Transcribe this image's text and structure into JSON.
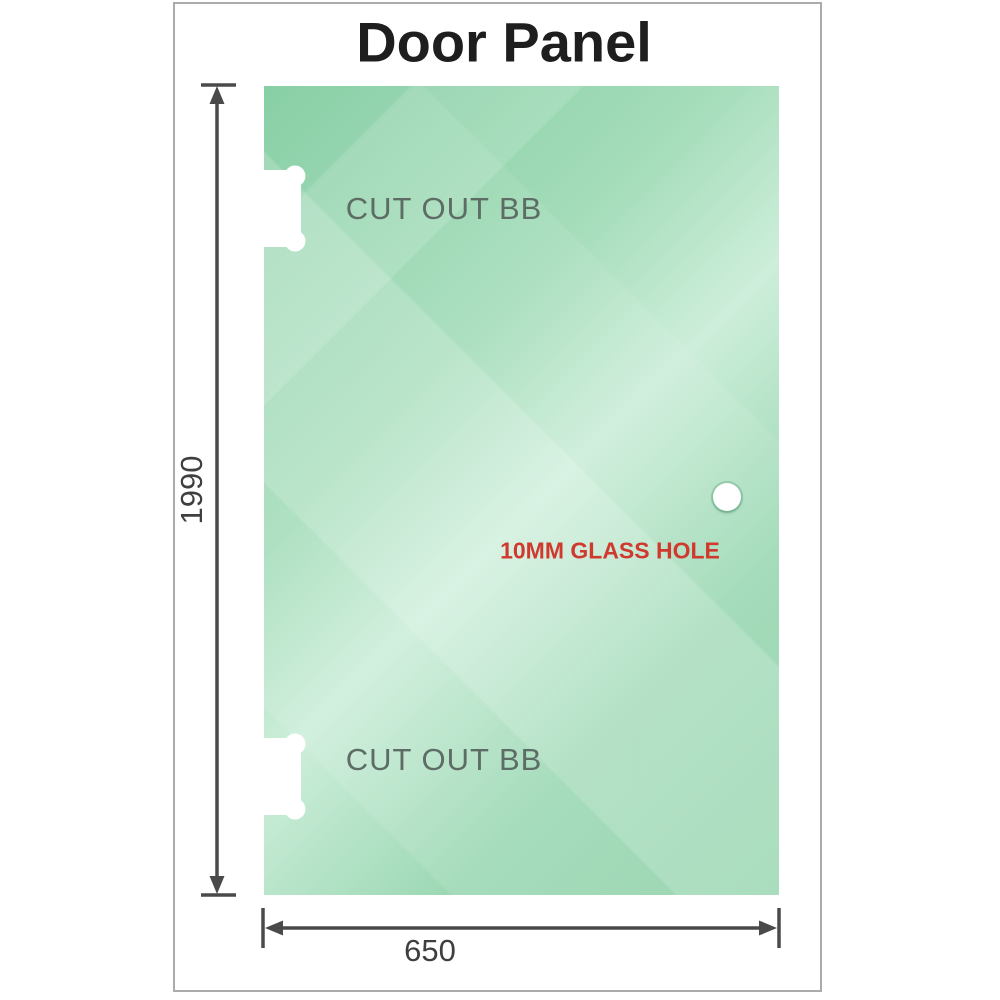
{
  "title": "Door Panel",
  "panel": {
    "cutout_top_label": "CUT OUT BB",
    "cutout_bottom_label": "CUT OUT BB",
    "hole_label": "10MM GLASS HOLE",
    "hole_label_color": "#d03a2e",
    "glass_color_dark": "#7ecb9e",
    "glass_color_light": "#cdeeda",
    "cutout_label_color": "#5d6d65"
  },
  "dimensions": {
    "height_label": "1990",
    "width_label": "650",
    "line_color": "#4a4a4a",
    "text_color": "#3f3f3f"
  },
  "frame": {
    "border_color": "#ababab"
  }
}
